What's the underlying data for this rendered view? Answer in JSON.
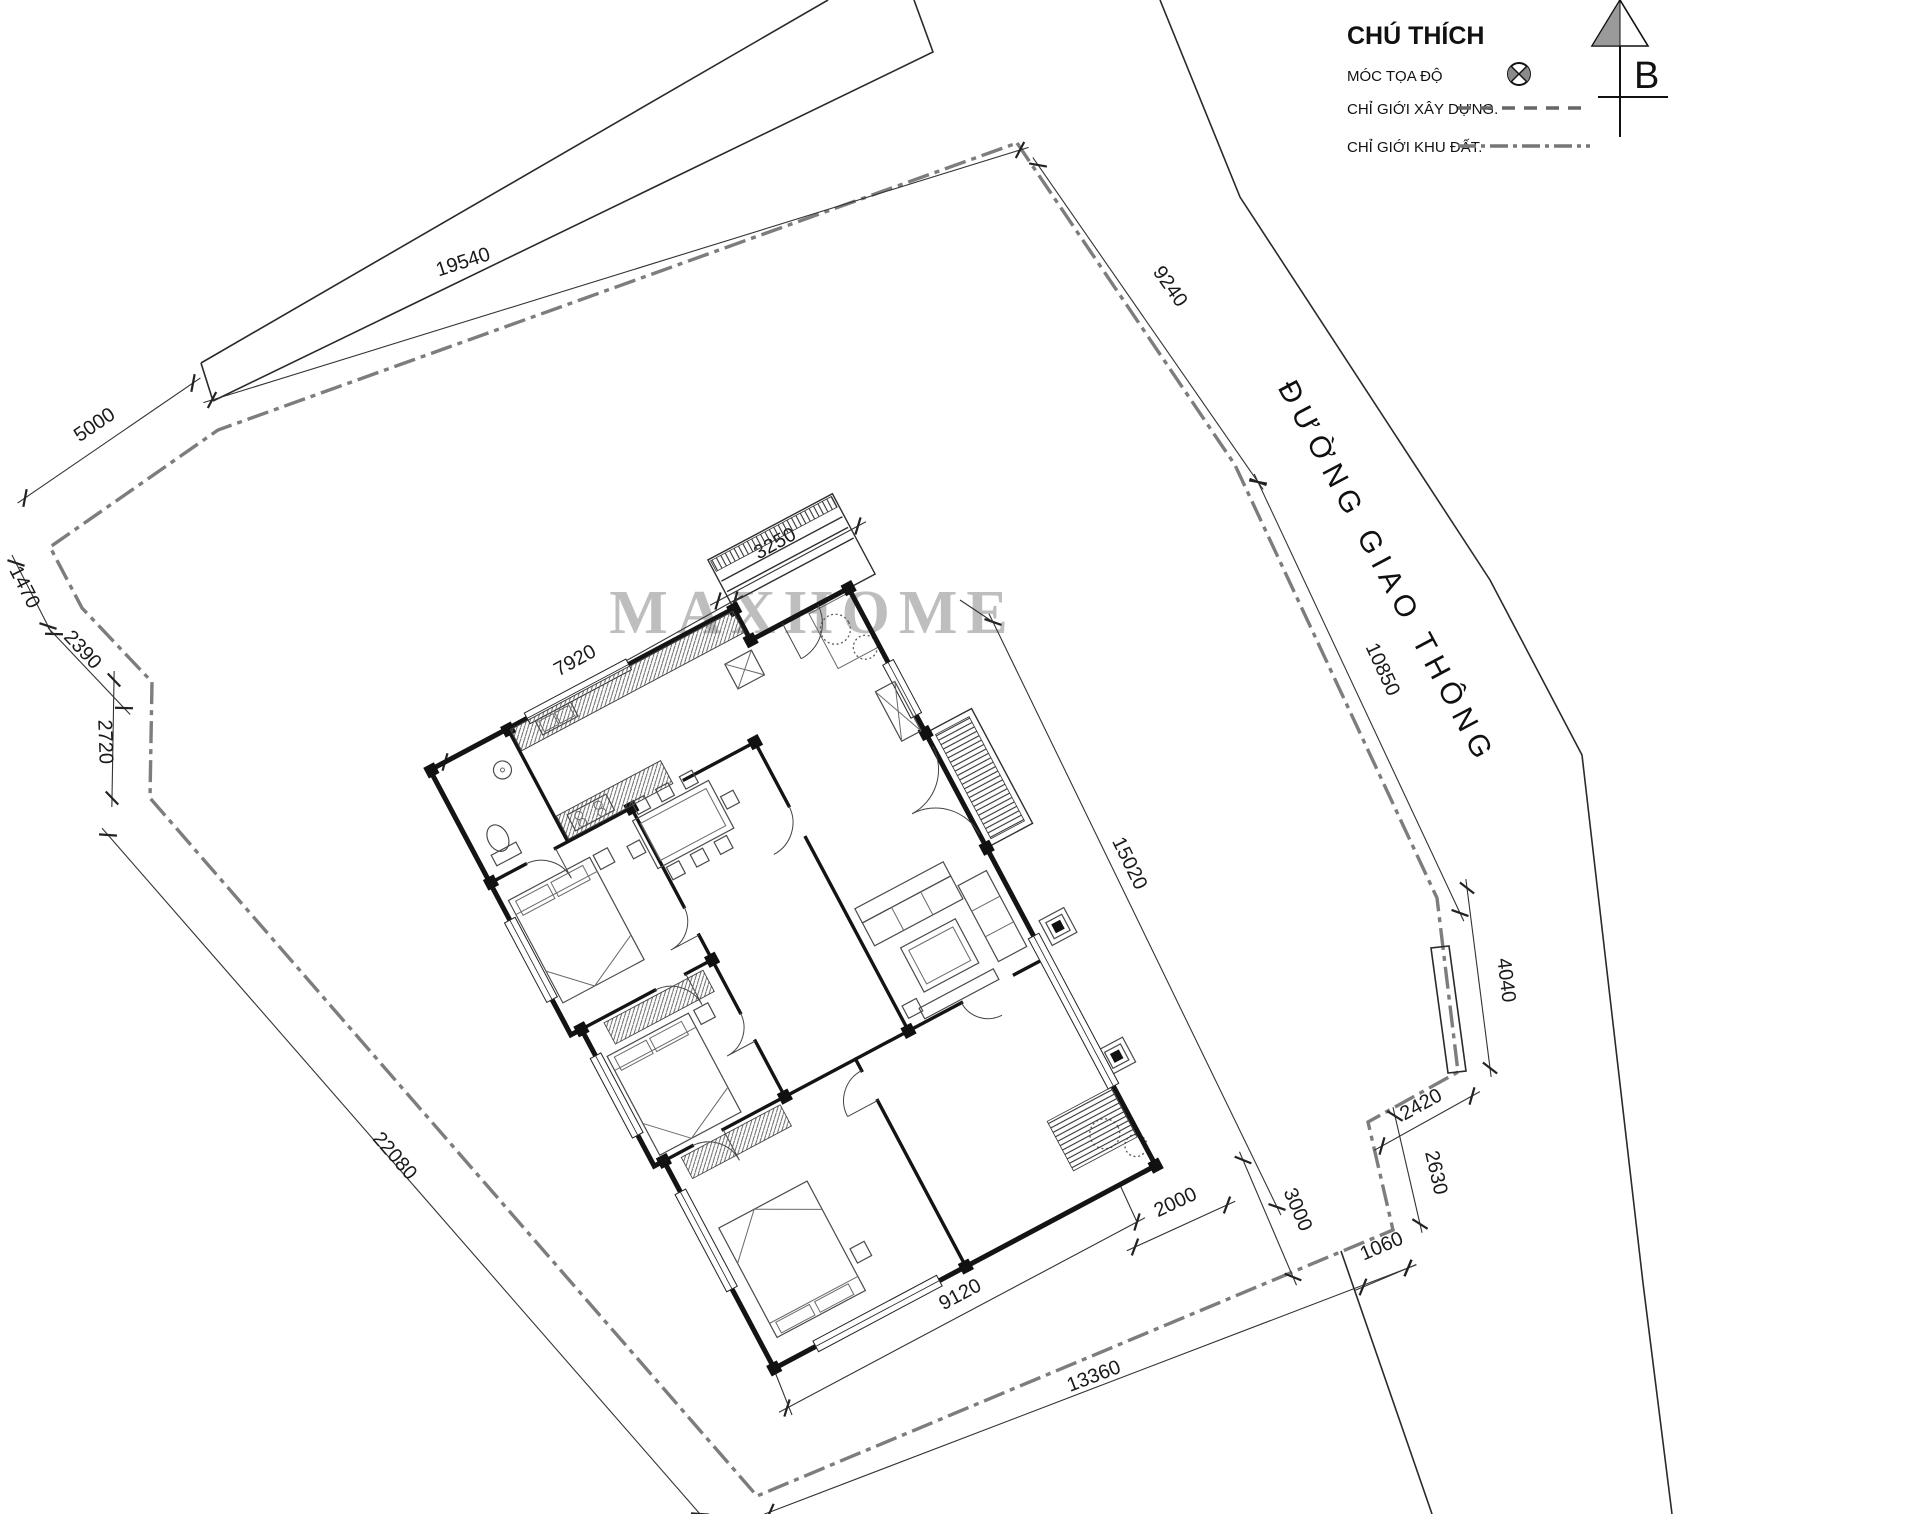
{
  "legend": {
    "title": "CHÚ THÍCH",
    "items": [
      {
        "label": "MÓC TỌA ĐỘ",
        "symbol": "survey-marker"
      },
      {
        "label": "CHỈ GIỚI XÂY DỰNG.",
        "symbol": "dashed-line"
      },
      {
        "label": "CHỈ GIỚI KHU ĐẤT.",
        "symbol": "dashdot-line"
      }
    ]
  },
  "north_arrow": {
    "label": "B"
  },
  "road": {
    "label": "ĐƯỜNG GIAO THÔNG"
  },
  "watermark": {
    "text": "MAXHOME"
  },
  "site": {
    "units": "mm",
    "dims": [
      {
        "label": "19540",
        "x1": 212,
        "y1": 400,
        "x2": 1020,
        "y2": 150,
        "lx": 465,
        "ly": 268,
        "rot": -18
      },
      {
        "label": "9240",
        "x1": 1038,
        "y1": 165,
        "x2": 1258,
        "y2": 482,
        "lx": 1165,
        "ly": 290,
        "rot": 55
      },
      {
        "label": "10850",
        "x1": 1258,
        "y1": 482,
        "x2": 1460,
        "y2": 913,
        "lx": 1377,
        "ly": 672,
        "rot": 65
      },
      {
        "label": "4040",
        "x1": 1467,
        "y1": 888,
        "x2": 1490,
        "y2": 1068,
        "lx": 1500,
        "ly": 981,
        "rot": 83
      },
      {
        "label": "2420",
        "x1": 1472,
        "y1": 1096,
        "x2": 1382,
        "y2": 1146,
        "lx": 1424,
        "ly": 1110,
        "rot": -29
      },
      {
        "label": "2630",
        "x1": 1395,
        "y1": 1116,
        "x2": 1420,
        "y2": 1224,
        "lx": 1430,
        "ly": 1174,
        "rot": 77
      },
      {
        "label": "1060",
        "x1": 1408,
        "y1": 1268,
        "x2": 1363,
        "y2": 1287,
        "lx": 1384,
        "ly": 1252,
        "rot": -23
      },
      {
        "label": "13360",
        "x1": 770,
        "y1": 1512,
        "x2": 1408,
        "y2": 1268,
        "lx": 1096,
        "ly": 1382,
        "rot": -21
      },
      {
        "label": "22080",
        "x1": 108,
        "y1": 835,
        "x2": 700,
        "y2": 1514,
        "lx": 390,
        "ly": 1160,
        "rot": 49
      },
      {
        "label": "2720",
        "x1": 114,
        "y1": 680,
        "x2": 112,
        "y2": 798,
        "lx": 99,
        "ly": 742,
        "rot": 88
      },
      {
        "label": "2390",
        "x1": 54,
        "y1": 634,
        "x2": 124,
        "y2": 708,
        "lx": 78,
        "ly": 654,
        "rot": 47
      },
      {
        "label": "1470",
        "x1": 16,
        "y1": 563,
        "x2": 48,
        "y2": 626,
        "lx": 19,
        "ly": 590,
        "rot": 63
      },
      {
        "label": "5000",
        "x1": 193,
        "y1": 383,
        "x2": 25,
        "y2": 498,
        "lx": 98,
        "ly": 430,
        "rot": -34
      },
      {
        "label": "7920",
        "x1": 445,
        "y1": 762,
        "x2": 735,
        "y2": 600,
        "lx": 578,
        "ly": 666,
        "rot": -29
      },
      {
        "label": "3250",
        "x1": 718,
        "y1": 601,
        "x2": 858,
        "y2": 526,
        "lx": 778,
        "ly": 549,
        "rot": -29
      },
      {
        "label": "9120",
        "x1": 787,
        "y1": 1408,
        "x2": 1137,
        "y2": 1222,
        "lx": 963,
        "ly": 1300,
        "rot": -28
      },
      {
        "label": "15020",
        "x1": 993,
        "y1": 622,
        "x2": 1277,
        "y2": 1207,
        "lx": 1124,
        "ly": 866,
        "rot": 64
      },
      {
        "label": "2000",
        "x1": 1135,
        "y1": 1247,
        "x2": 1227,
        "y2": 1205,
        "lx": 1178,
        "ly": 1208,
        "rot": -25
      },
      {
        "label": "3000",
        "x1": 1243,
        "y1": 1160,
        "x2": 1293,
        "y2": 1277,
        "lx": 1292,
        "ly": 1212,
        "rot": 67
      }
    ]
  },
  "colors": {
    "boundary": "#7d7d7d",
    "line": "#1a1a1a",
    "wall": "#141414",
    "watermark": "#b8b8b8"
  }
}
